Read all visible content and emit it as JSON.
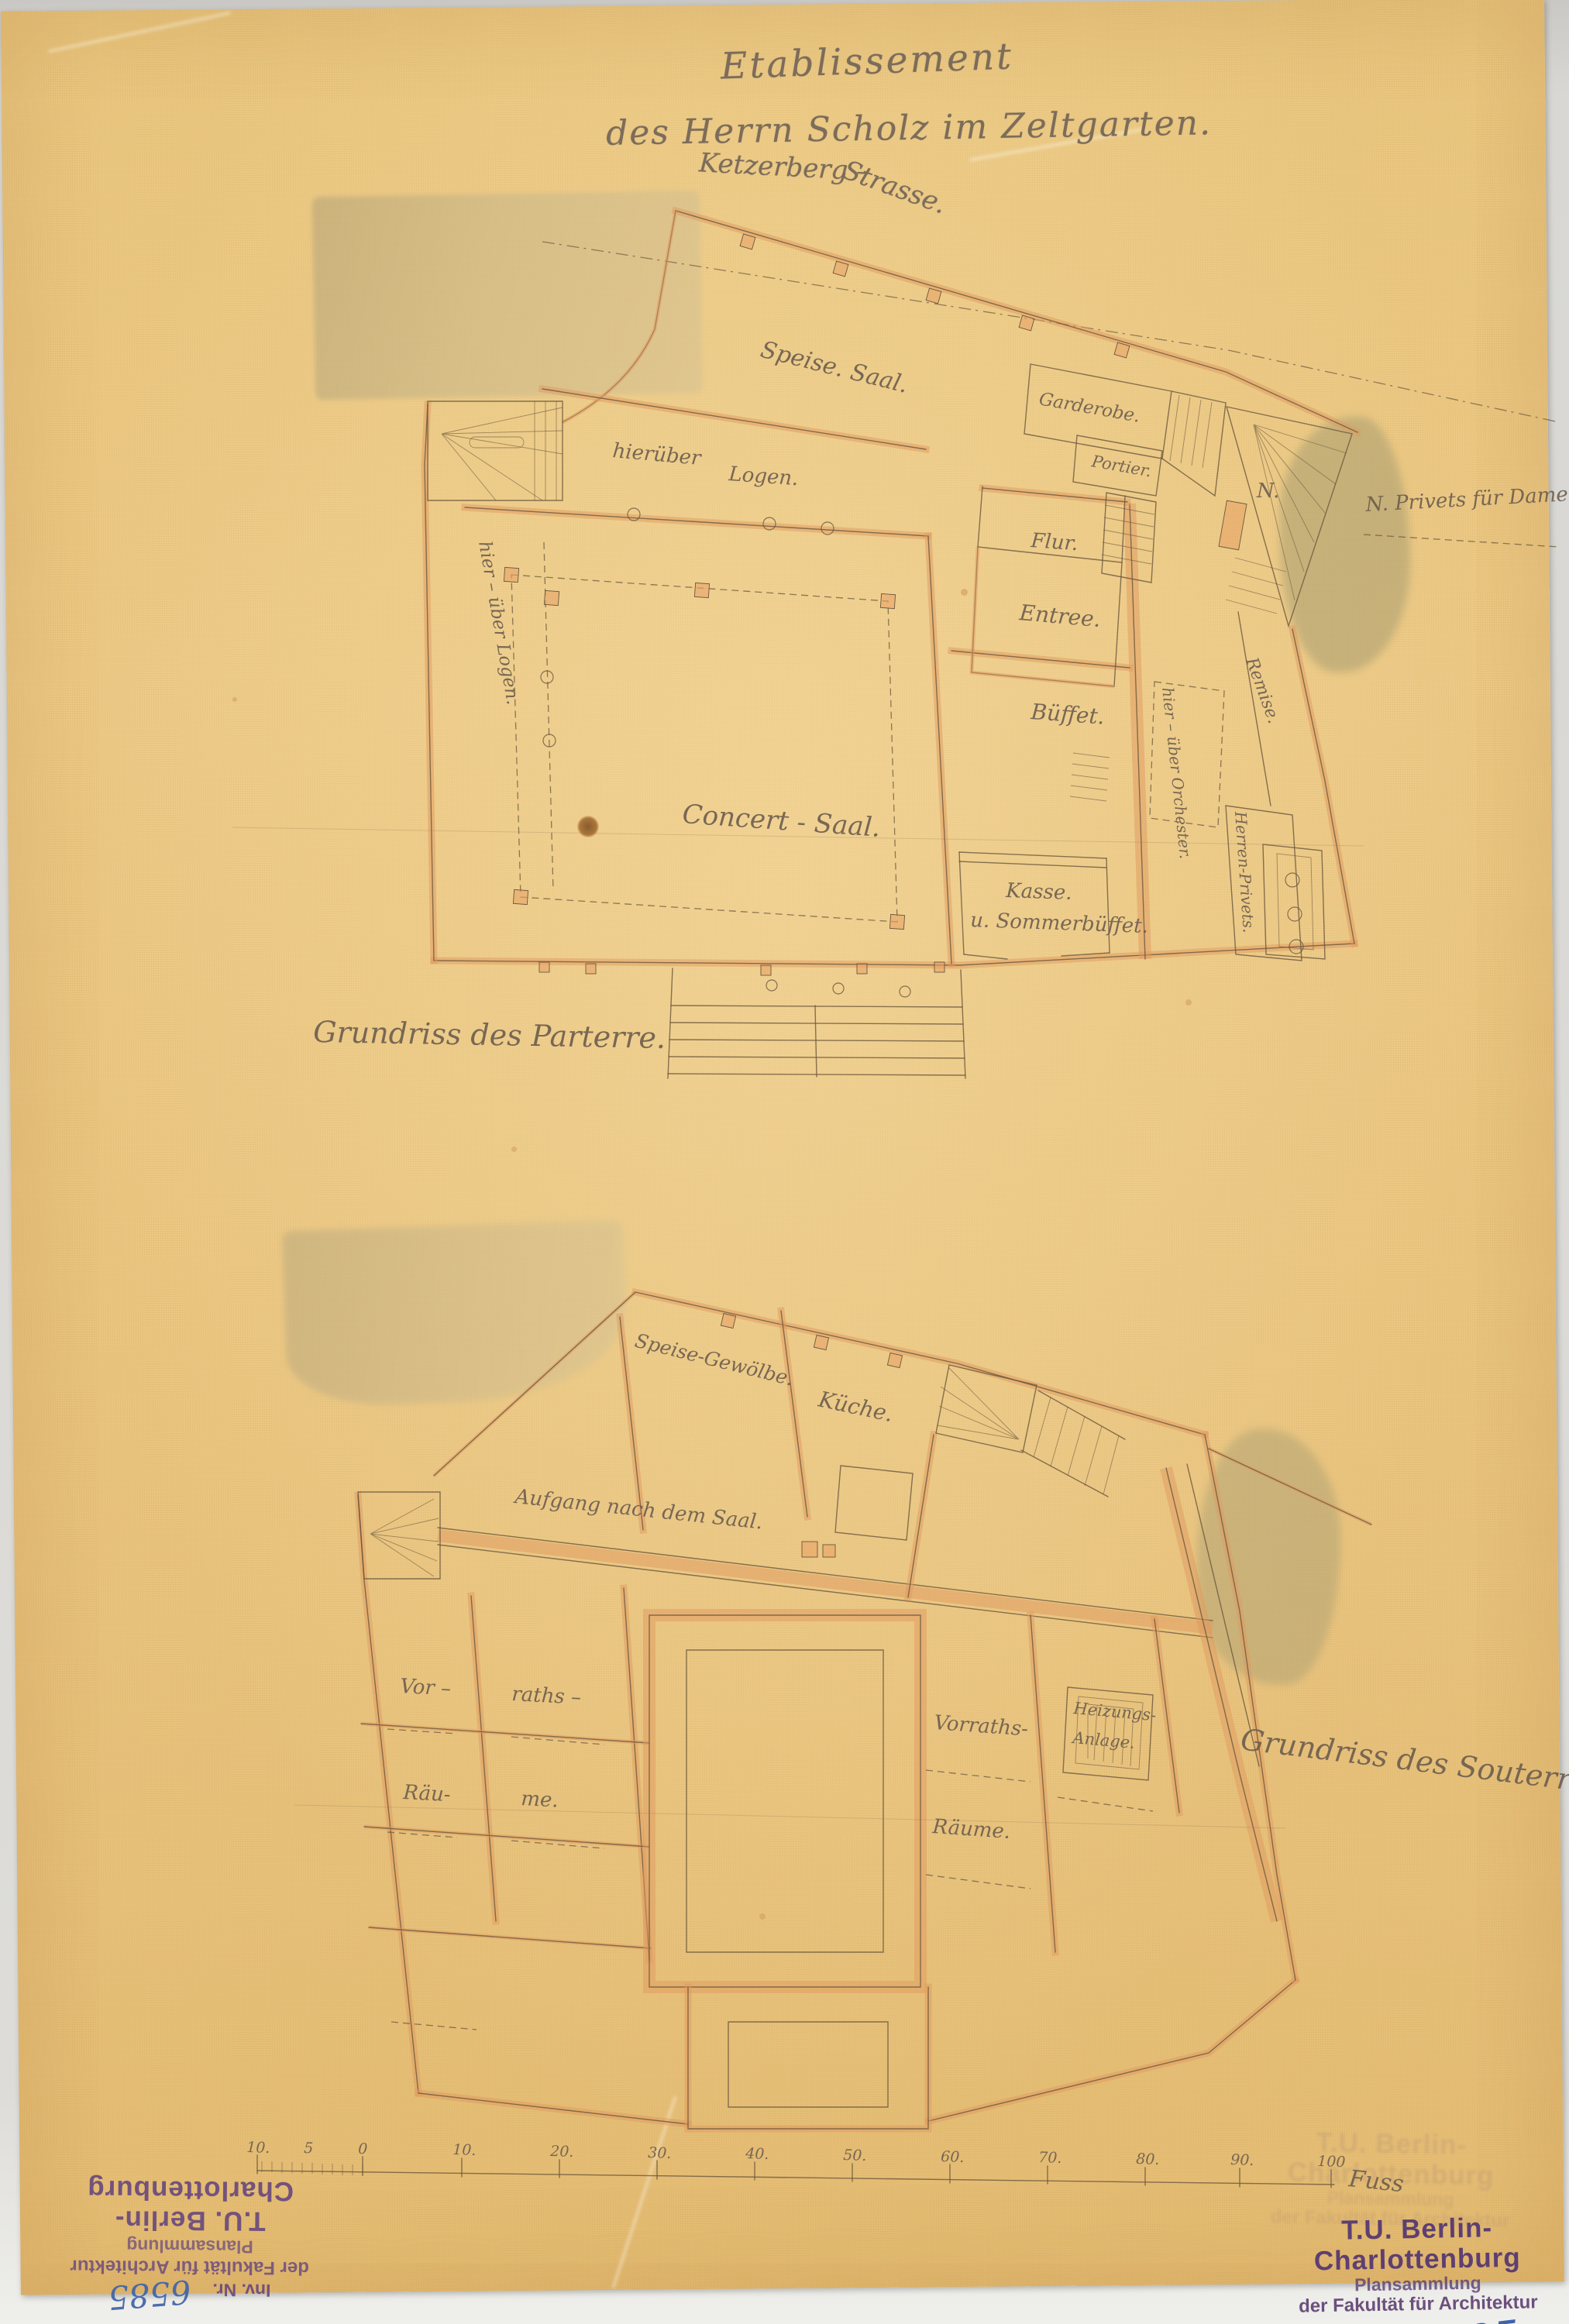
{
  "document": {
    "title_line1": "Etablissement",
    "title_line2": "des Herrn Scholz im Zeltgarten.",
    "street_part1": "Ketzerberg  –",
    "street_part2": "Strasse.",
    "caption_parterre": "Grundriss des Parterre.",
    "caption_souterrain": "Grundriss des Souterrain.",
    "annotation_privets": "N. Privets für Damen",
    "label_n": "N."
  },
  "parterre": {
    "speisesaal": "Speise. Saal.",
    "garderobe": "Garderobe.",
    "portier": "Portier.",
    "flur": "Flur.",
    "entree": "Entree.",
    "hierueber": "hierüber",
    "logen": "Logen.",
    "logen_side": "hier – über Logen.",
    "concertsaal": "Concert - Saal.",
    "bueffet": "Büffet.",
    "orchester": "hier – über Orchester.",
    "remise": "Remise.",
    "kasse": "Kasse.",
    "sommerbueffet": "u. Sommerbüffet.",
    "privets": "Herren-Privets."
  },
  "souterrain": {
    "gewoelbe": "Speise-Gewölbe.",
    "kueche": "Küche.",
    "aufgang": "Aufgang nach dem Saal.",
    "vor": "Vor –",
    "raths": "raths –",
    "raeu": "Räu-",
    "me": "me.",
    "vorraths": "Vorraths-",
    "raeume": "Räume.",
    "heizungs": "Heizungs-",
    "anlage": "Anlage."
  },
  "scale_bar": {
    "labels": [
      "10.",
      "5",
      "0",
      "10.",
      "20.",
      "30.",
      "40.",
      "50.",
      "60.",
      "70.",
      "80.",
      "90.",
      "100"
    ],
    "unit": "Fuss"
  },
  "stamp": {
    "line1": "T.U. Berlin-Charlottenburg",
    "line2": "Plansammlung",
    "line3": "der Fakultät für Architektur",
    "line4": "Inv. Nr.",
    "number": "6585"
  }
}
